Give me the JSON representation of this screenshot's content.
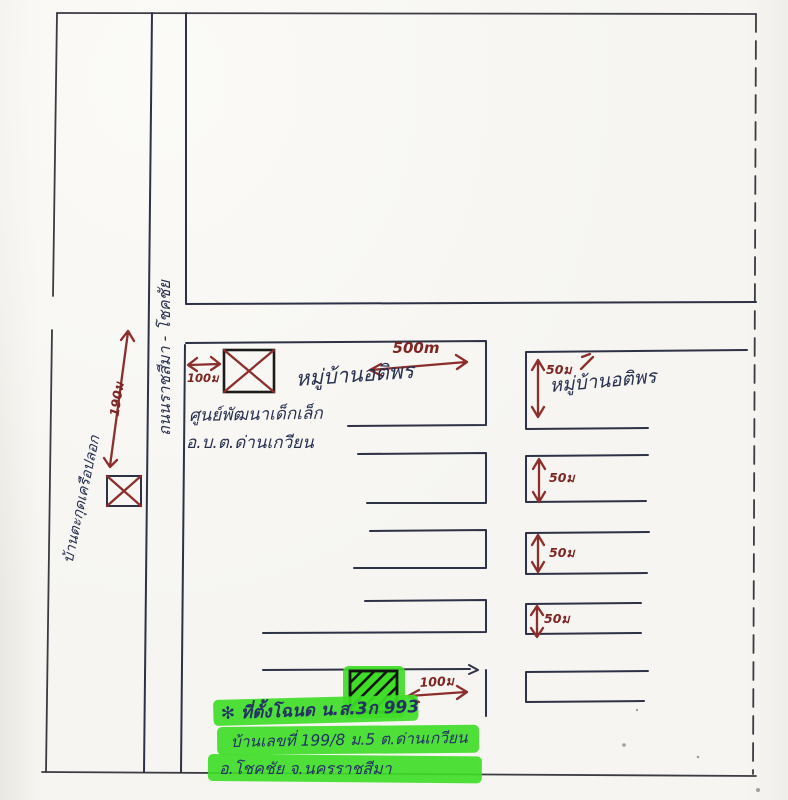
{
  "map": {
    "road_label_vertical": "ถนนราชสีมา - โชคชัย",
    "left_village_label": "บ้านตะกุดเครือปลอก",
    "left_block": {
      "village_name": "หมู่บ้านอติพร",
      "center_name": "ศูนย์พัฒนาเด็กเล็ก",
      "center_org": "อ.บ.ต.ด่านเกวียน"
    },
    "right_block": {
      "village_name": "หมู่บ้านอติพร"
    },
    "distances": {
      "top_left": "100ม",
      "frontage": "500m",
      "road_left": "190ม",
      "soi": [
        "50ม",
        "50ม",
        "50ม",
        "50ม"
      ],
      "bottom": "100ม"
    },
    "note": {
      "line1": "✻ ที่ตั้งโฉนด น.ส.3ก 993",
      "line2": "บ้านเลขที่ 199/8 ม.5 ต.ด่านเกวียน",
      "line3": "อ.โชคชัย จ.นครราชสีมา"
    },
    "icons": {
      "landmark_top": "crossed-box-marker",
      "landmark_road": "crossed-box-marker",
      "site": "hatched-plot-marker"
    },
    "colors": {
      "ink": "#2e3246",
      "arrow_red": "#8c2e2b",
      "highlight_green": "#3fdd28",
      "paper": "#f6f5f1"
    }
  }
}
